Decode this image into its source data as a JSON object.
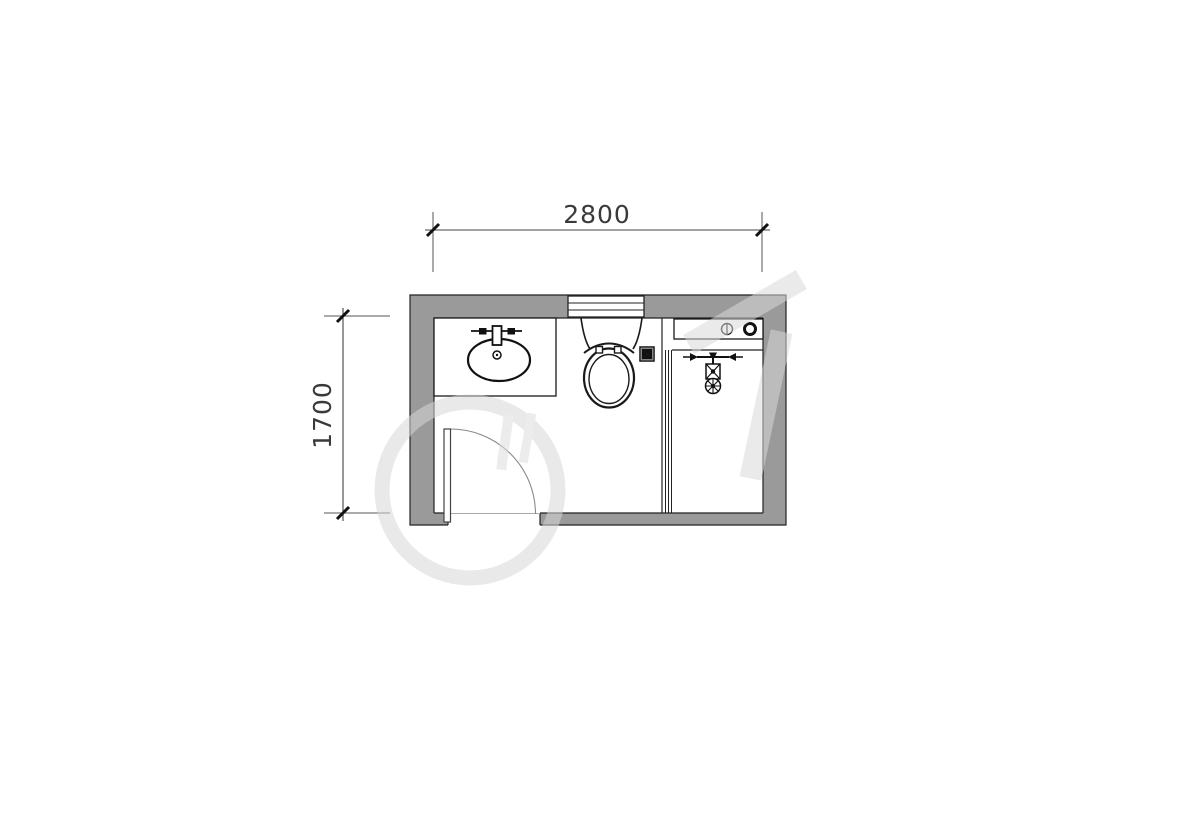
{
  "drawing": {
    "kind": "bathroom-floor-plan",
    "dimensions": {
      "width_label": "2800",
      "height_label": "1700"
    },
    "colors": {
      "wall_fill": "#9a9a9a",
      "outline": "#222222",
      "fixture_line": "#111111",
      "dim_line": "#3c3c3c",
      "door_arc": "#888888",
      "watermark": "#d7d7d7",
      "background": "#ffffff"
    },
    "fixtures": [
      "window",
      "sink-counter",
      "washbasin",
      "faucet",
      "toilet",
      "floor-drain",
      "shower-partition",
      "shower-mixer",
      "appliance-counter",
      "door"
    ],
    "icons": [
      "faucet-icon",
      "floor-drain-icon",
      "shower-mixer-icon",
      "tap-circle-icon",
      "water-ring-icon"
    ]
  }
}
